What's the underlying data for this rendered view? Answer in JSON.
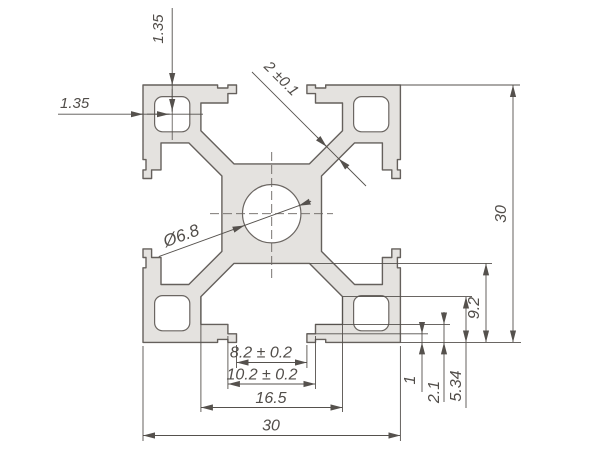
{
  "drawing": {
    "type": "aluminium-extrusion-profile-cross-section",
    "dimensions": {
      "overall_width_bottom": "30",
      "overall_height_right": "30",
      "slot_cavity_width": "16.5",
      "slot_step_width": "10.2 ± 0.2",
      "slot_opening_width": "8.2 ± 0.2",
      "center_hole_diameter": "Ø6.8",
      "web_thickness": "2 ±0.1",
      "corner_hole_offset_top": "1.35",
      "corner_hole_offset_left": "1.35",
      "lip_depth": "1",
      "step_depth": "2.1",
      "wall_depth": "5.34",
      "cavity_depth": "9.2"
    },
    "colors": {
      "profile_fill": "#e4e2df",
      "profile_outline": "#65605c",
      "dimension_lines": "#55514d",
      "background": "#ffffff"
    }
  }
}
